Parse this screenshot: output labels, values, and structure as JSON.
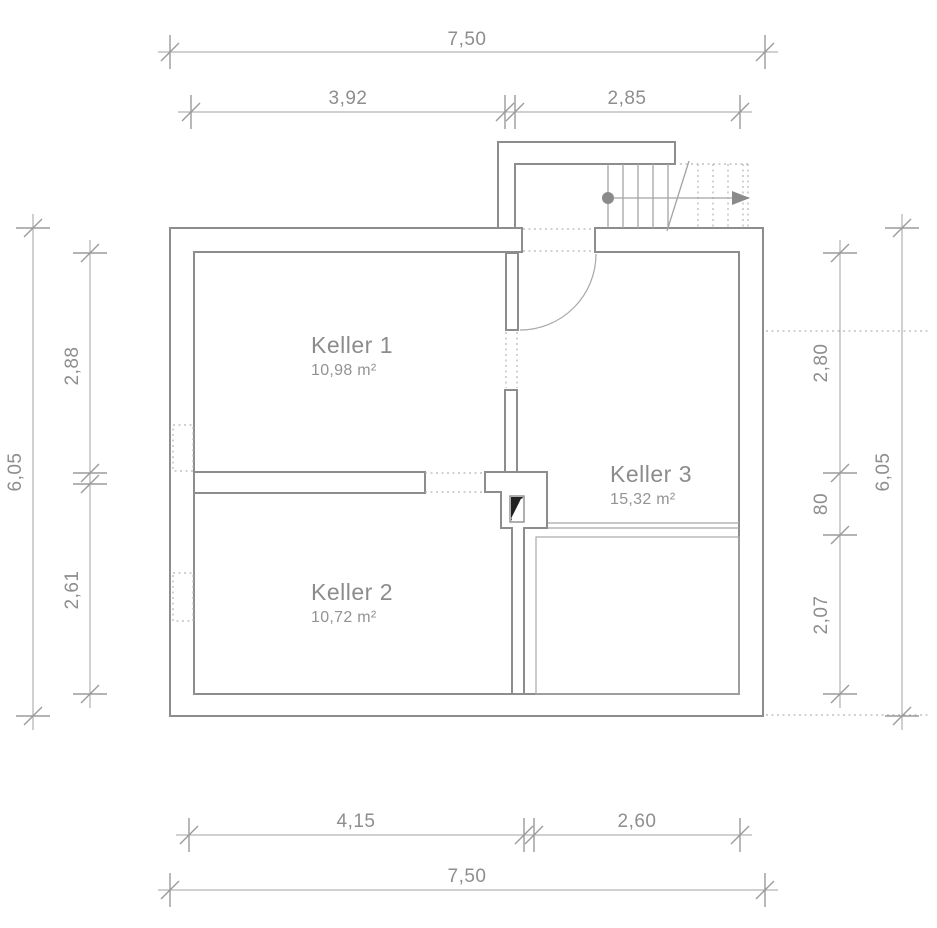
{
  "plan": {
    "type": "basement-floor-plan",
    "rooms": [
      {
        "name": "Keller 1",
        "area": "10,98 m²"
      },
      {
        "name": "Keller 2",
        "area": "10,72 m²"
      },
      {
        "name": "Keller 3",
        "area": "15,32 m²"
      }
    ],
    "dims": {
      "top_total": "7,50",
      "top_seg1": "3,92",
      "top_seg2": "2,85",
      "bottom_seg1": "4,15",
      "bottom_seg2": "2,60",
      "bottom_total": "7,50",
      "left_total": "6,05",
      "left_seg1": "2,88",
      "left_seg2": "2,61",
      "right_seg1": "2,80",
      "right_seg2": "80",
      "right_seg3": "2,07",
      "right_total": "6,05"
    },
    "colors": {
      "wall_line": "#8d8d8d",
      "dim_line": "#a0a0a0",
      "label_text": "#8c8c8c",
      "chimney_fill": "#222222"
    }
  }
}
